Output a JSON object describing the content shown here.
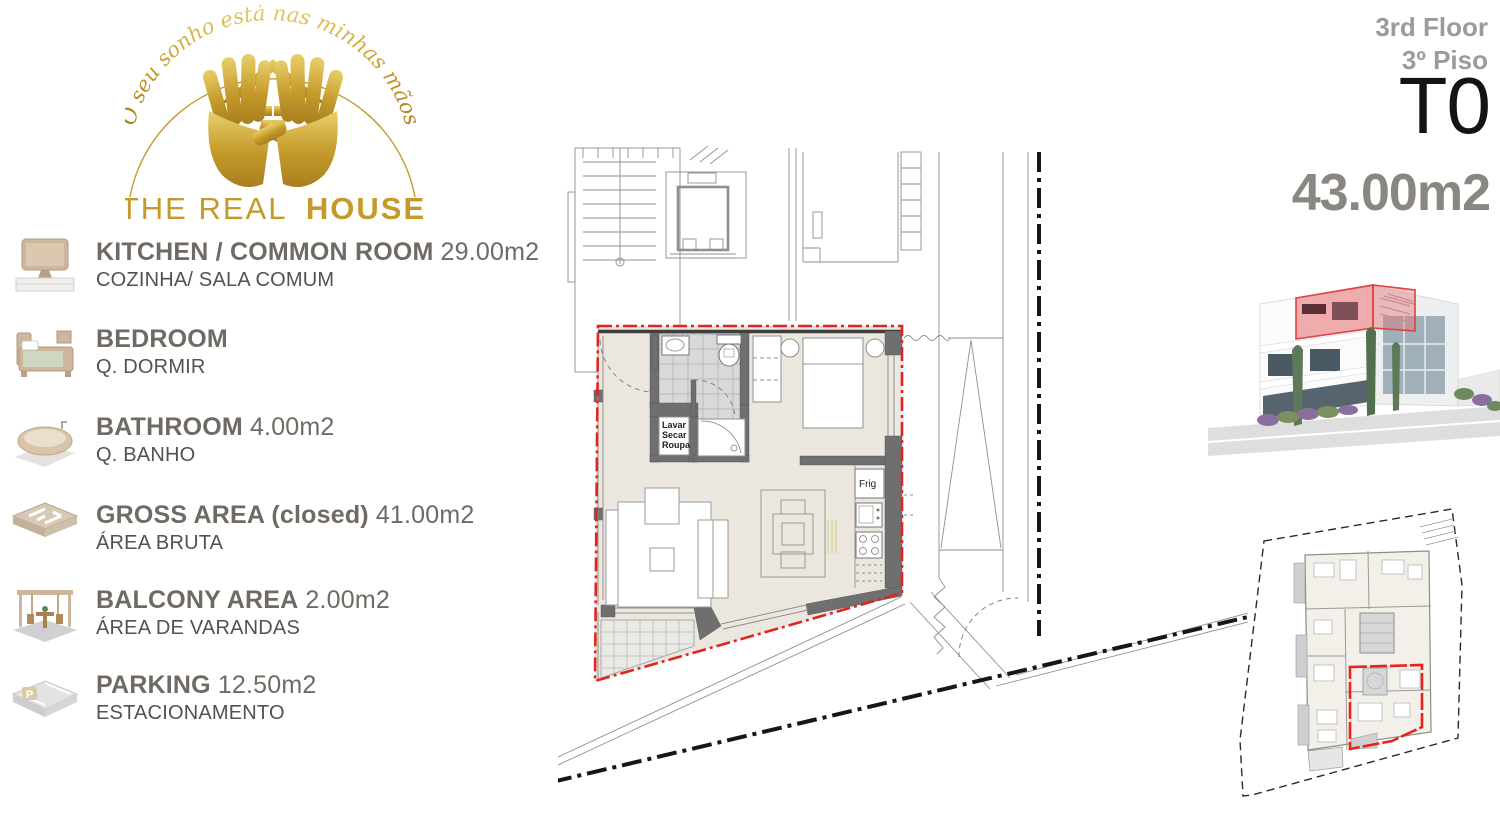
{
  "logo": {
    "arc_text": "O seu sonho está nas minhas mãos",
    "brand_regular": "THE REAL",
    "brand_bold": "HOUSE",
    "gold": "#c49a2a"
  },
  "legend": {
    "items": [
      {
        "icon": "tv-icon",
        "title": "KITCHEN / COMMON ROOM",
        "value": "29.00m2",
        "subtitle": "COZINHA/ SALA COMUM"
      },
      {
        "icon": "bed-icon",
        "title": "BEDROOM",
        "value": "",
        "subtitle": "Q. DORMIR"
      },
      {
        "icon": "bathtub-icon",
        "title": "BATHROOM",
        "value": "4.00m2",
        "subtitle": "Q. BANHO"
      },
      {
        "icon": "floorplan-icon",
        "title": "GROSS AREA (closed)",
        "value": "41.00m2",
        "subtitle": "ÁREA BRUTA"
      },
      {
        "icon": "balcony-icon",
        "title": "BALCONY AREA",
        "value": "2.00m2",
        "subtitle": "ÁREA DE VARANDAS"
      },
      {
        "icon": "parking-icon",
        "title": "PARKING",
        "value": "12.50m2",
        "subtitle": "ESTACIONAMENTO"
      }
    ]
  },
  "unit_header": {
    "floor_en": "3rd Floor",
    "floor_pt": "3º Piso",
    "unit_type": "T0",
    "total_area": "43.00m2"
  },
  "floorplan": {
    "laundry_line1": "Lavar",
    "laundry_line2": "Secar",
    "laundry_line3": "Roupa",
    "fridge_label": "Frig",
    "colors": {
      "boundary_red": "#e02420",
      "wall_gray": "#6f6f6f",
      "floor_beige": "#ece7de"
    }
  },
  "building_render": {
    "highlight_red": "#e04040"
  },
  "site_plan": {
    "unit_red": "#e8231d"
  }
}
